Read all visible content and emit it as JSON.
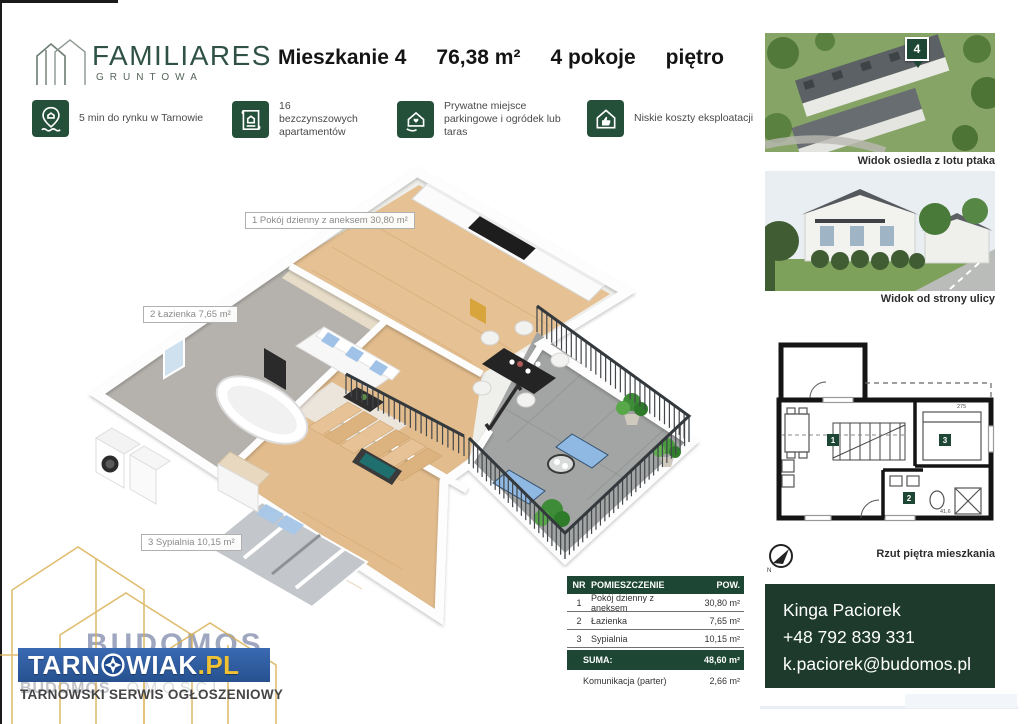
{
  "brand": {
    "name": "FAMILIARES",
    "sub": "GRUNTOWA"
  },
  "title": {
    "name": "Mieszkanie 4",
    "area": "76,38 m²",
    "rooms": "4 pokoje",
    "floor": "piętro"
  },
  "features": [
    {
      "icon": "map-pin-house-icon",
      "text": "5 min do rynku w Tarnowie"
    },
    {
      "icon": "blueprint-house-icon",
      "text": "16 bezczynszowych apartamentów"
    },
    {
      "icon": "house-heart-hand-icon",
      "text": "Prywatne miejsce parkingowe i ogródek lub taras"
    },
    {
      "icon": "house-thumbs-up-icon",
      "text": "Niskie koszty eksploatacji"
    }
  ],
  "plan3d": {
    "labels": [
      "1 Pokój dzienny z aneksem 30,80 m²",
      "2 Łazienka 7,65 m²",
      "3 Sypialnia 10,15 m²"
    ]
  },
  "photos": {
    "aerial": {
      "marker": "4",
      "caption": "Widok osiedla z lotu ptaka"
    },
    "street": {
      "caption": "Widok od strony ulicy"
    }
  },
  "plan2d": {
    "caption": "Rzut piętra mieszkania",
    "rooms": [
      "1",
      "2",
      "3"
    ],
    "dims": [
      "275",
      "41,6"
    ],
    "compass": "N"
  },
  "table": {
    "col_nr": "NR",
    "col_room": "POMIESZCZENIE",
    "col_area": "POW.",
    "rows": [
      [
        "1",
        "Pokój dzienny z aneksem",
        "30,80 m²"
      ],
      [
        "2",
        "Łazienka",
        "7,65 m²"
      ],
      [
        "3",
        "Sypialnia",
        "10,15 m²"
      ]
    ],
    "suma_label": "SUMA:",
    "suma_value": "48,60 m²",
    "extra_name": "Komunikacja (parter)",
    "extra_value": "2,66 m²"
  },
  "contact": {
    "name": "Kinga Paciorek",
    "phone": "+48 792 839 331",
    "email": "k.paciorek@budomos.pl"
  },
  "footer": {
    "logo_pre": "TARN",
    "logo_post": "WIAK",
    "logo_tld": ".PL",
    "tagline": "TARNOWSKI SERWIS OGŁOSZENIOWY",
    "ghost": "BUDOMOS",
    "ghost2": "OMOŚCI"
  },
  "colors": {
    "green_dark": "#1e4634",
    "green_icon": "#24503a",
    "contact_bg": "#1d3a2c",
    "brand_green": "#2f5244",
    "blue_bar": "#2f5fa8",
    "tld_yellow": "#f0c233",
    "gold_watermark": "#d9ae4e"
  }
}
